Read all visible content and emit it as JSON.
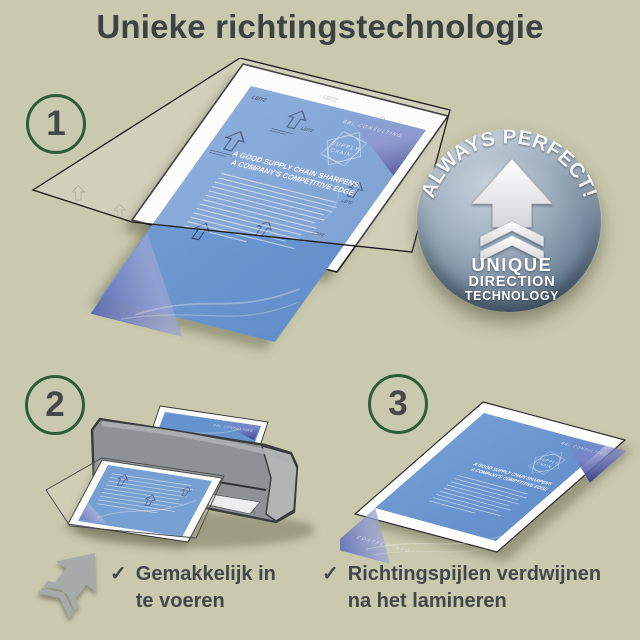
{
  "page": {
    "title": "Unieke richtingstechnologie"
  },
  "palette": {
    "background": "#c9c9ae",
    "title_text": "#3d4345",
    "step_ring_green": "#2d5c35",
    "step_number": "#45494b",
    "document_blue": "#6593cd",
    "navy_print": "#2c3b66",
    "machine_gray": "#8f9294",
    "badge_light": "#c6d0da",
    "badge_dark": "#46586b",
    "caption_text": "#42474a"
  },
  "steps": [
    {
      "number": "1"
    },
    {
      "number": "2"
    },
    {
      "number": "3"
    }
  ],
  "badge": {
    "curved_text": "ALWAYS PERFECT!",
    "line1": "UNIQUE",
    "line2": "DIRECTION",
    "line3": "TECHNOLOGY"
  },
  "document": {
    "brand": "LEITZ",
    "logo_line1": "SUPPLY",
    "logo_line2": "CHAIN",
    "heading_line1": "A GOOD SUPPLY CHAIN SHARPENS",
    "heading_line2": "A COMPANY'S COMPETITIVE EDGE",
    "header_right": "BBL CONSULTING",
    "footer_left": "CONTACT INFO"
  },
  "captions": {
    "left": {
      "check": "✓",
      "line1": "Gemakkelijk in",
      "line2": "te voeren"
    },
    "right": {
      "check": "✓",
      "line1": "Richtingspijlen verdwijnen",
      "line2": "na het lamineren"
    }
  }
}
